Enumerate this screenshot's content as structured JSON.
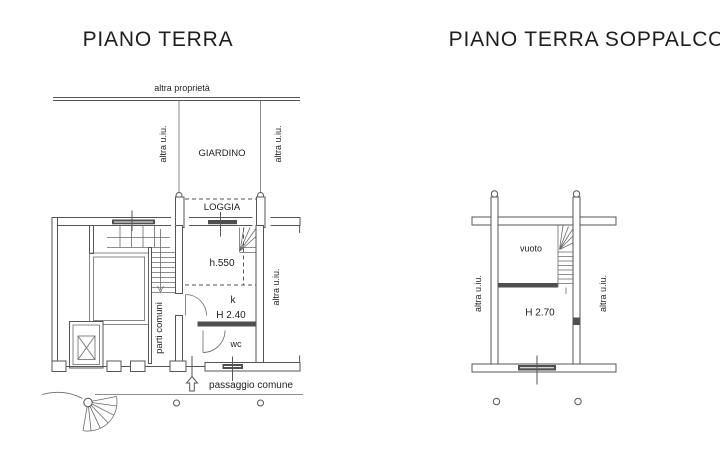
{
  "colors": {
    "background": "#ffffff",
    "drawing_line": "#555555",
    "dark_fill": "#4f4f4f",
    "text": "#1e1e1e"
  },
  "left_plan": {
    "title": "PIANO TERRA",
    "labels": {
      "altra_proprieta": "altra proprietà",
      "giardino": "GIARDINO",
      "loggia": "LOGGIA",
      "altra_uiu_giardino_left": "altra u.iu.",
      "altra_uiu_giardino_right": "altra u.iu.",
      "altra_uiu_strip_right": "altra u.iu.",
      "parti_comuni": "parti comuni",
      "main_room_height": "h.550",
      "kitchen": "k",
      "kitchen_height": "H 2.40",
      "wc": "wc",
      "passaggio_comune": "passaggio comune"
    }
  },
  "right_plan": {
    "title": "PIANO TERRA SOPPALCO",
    "labels": {
      "vuoto": "vuoto",
      "room_height": "H 2.70",
      "altra_uiu_left": "altra u.iu.",
      "altra_uiu_right": "altra u.iu."
    }
  }
}
